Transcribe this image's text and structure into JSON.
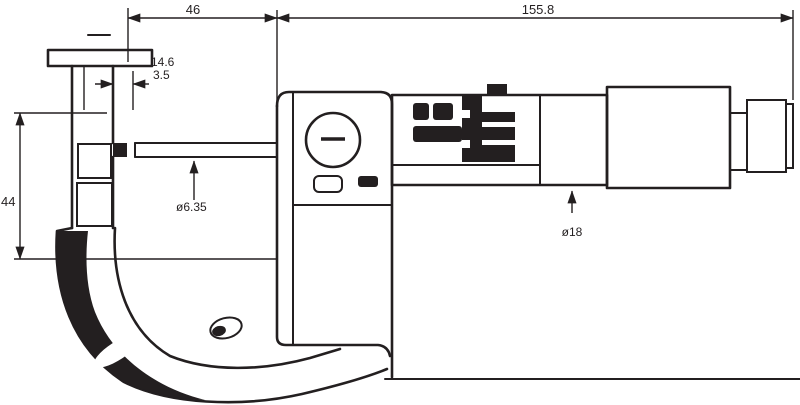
{
  "drawing": {
    "background": "#ffffff",
    "ink": "#231f20",
    "dimensions": {
      "top_segment_left": "46",
      "top_segment_right": "155.8",
      "left_height": "44",
      "anvil_depth": "14.6",
      "tip_thickness": "3.5",
      "spindle_diameter": "ø6.35",
      "thimble_diameter": "ø18"
    },
    "parts": [
      "frame",
      "anvil",
      "spindle",
      "insulating-plates",
      "display-housing",
      "battery-cap",
      "origin-button",
      "sleeve",
      "spindle-clamp",
      "thimble",
      "ratchet-stop",
      "baseline"
    ]
  }
}
